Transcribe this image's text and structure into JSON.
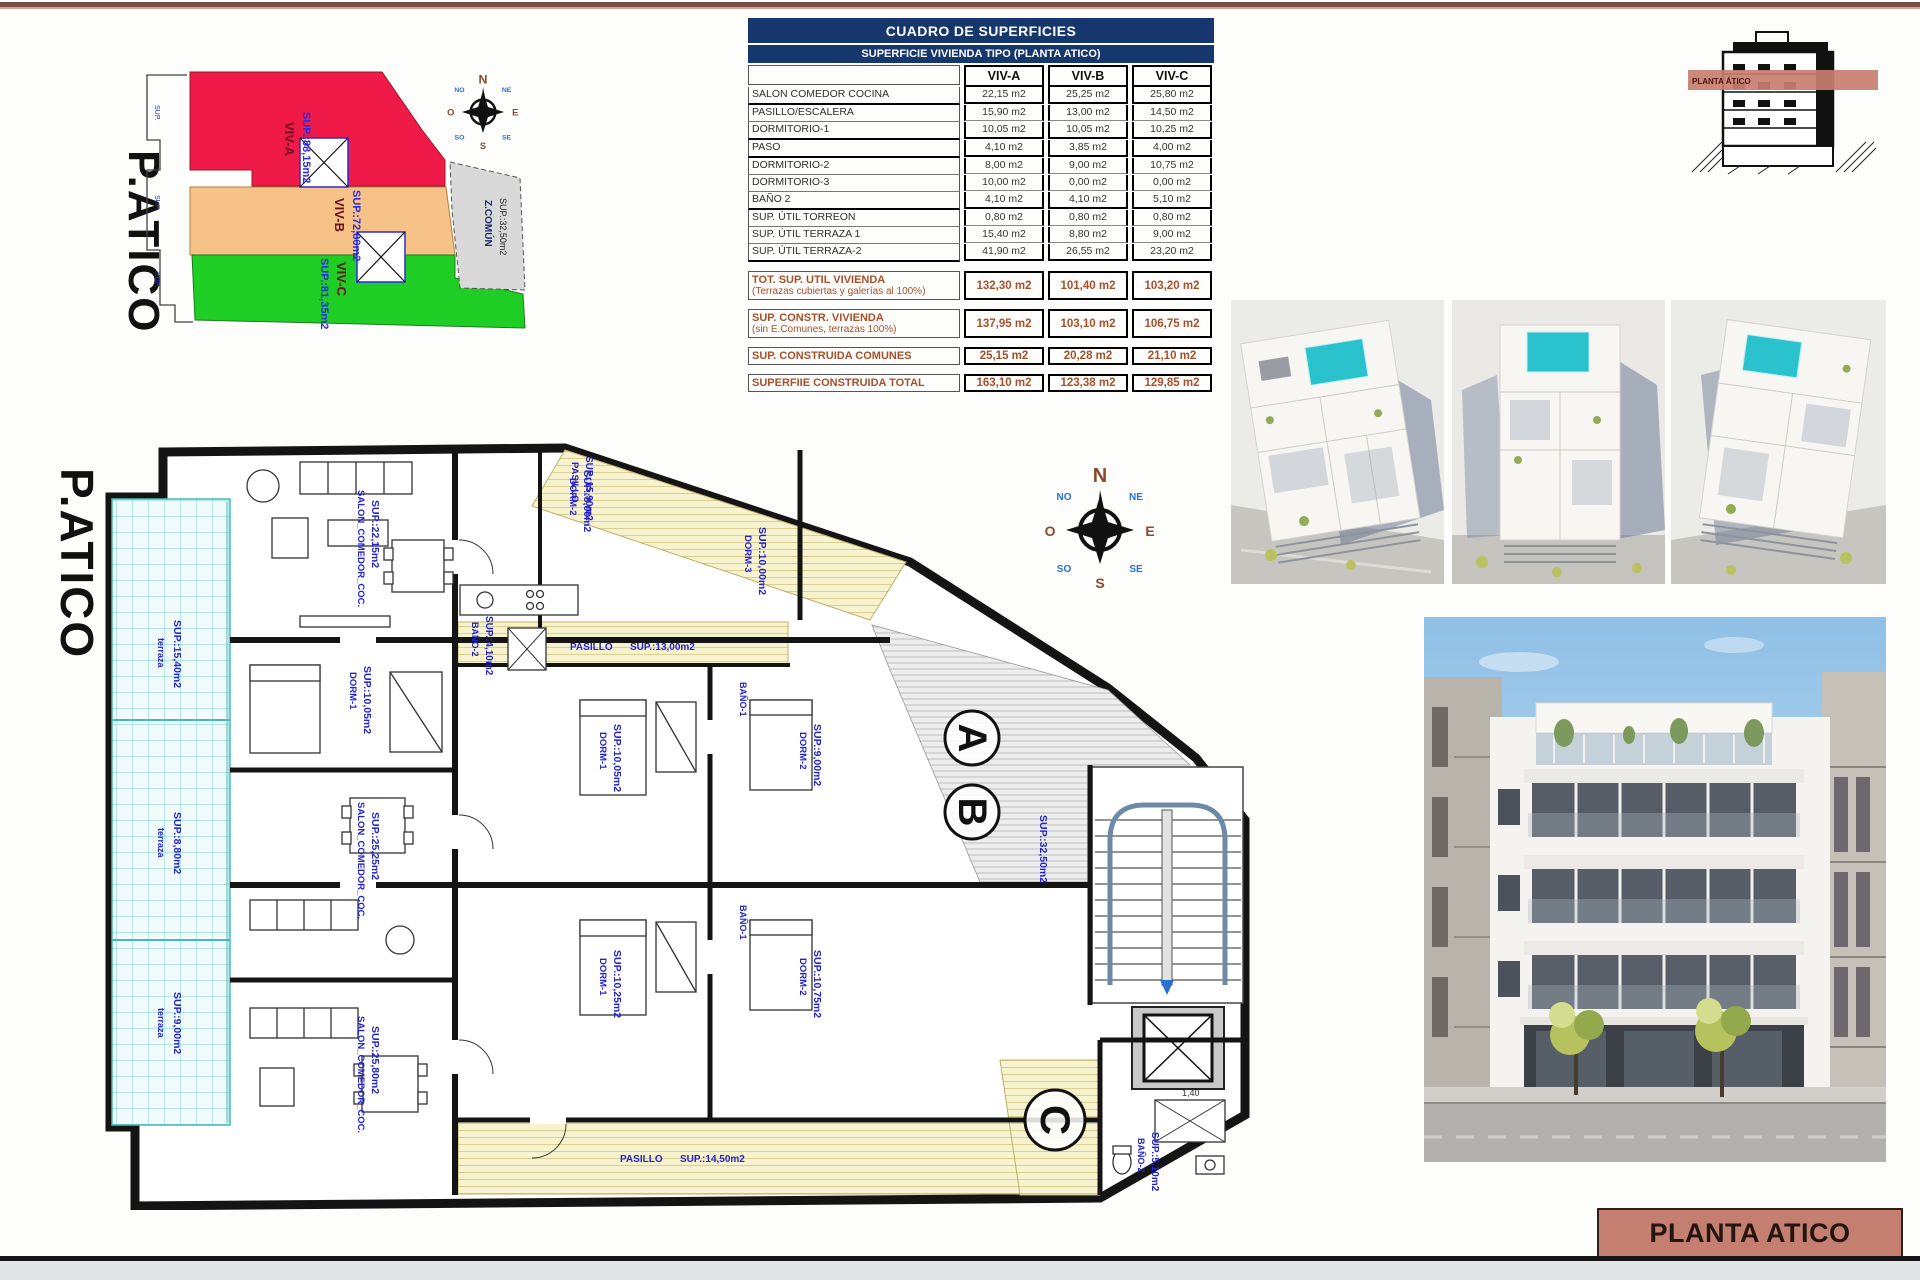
{
  "key_plan": {
    "title": "P.ATICO",
    "viv_a": "VIV-A",
    "viv_a_sup": "SUP.:88,15m2",
    "viv_b": "VIV-B",
    "viv_b_sup": "SUP.:72,80m2",
    "viv_c": "VIV-C",
    "viv_c_sup": "SUP.:81,35m2",
    "z_comun": "Z.COMÚN",
    "z_comun_sup": "SUP.:32,50m2",
    "edge_label_1": "SUP.",
    "edge_label_2": "SUP.",
    "edge_label_3": "SUP."
  },
  "compass": {
    "n": "N",
    "e": "E",
    "s": "S",
    "o": "O",
    "ne": "NE",
    "no": "NO",
    "se": "SE",
    "so": "SO"
  },
  "surface_table": {
    "title": "CUADRO DE SUPERFICIES",
    "subtitle": "SUPERFICIE VIVIENDA TIPO  (PLANTA ATICO)",
    "columns": {
      "a": "VIV-A",
      "b": "VIV-B",
      "c": "VIV-C"
    },
    "rows": [
      {
        "label": "SALON COMEDOR COCINA",
        "a": "22,15 m2",
        "b": "25,25 m2",
        "c": "25,80 m2"
      },
      {
        "label": "PASILLO/ESCALERA",
        "a": "15,90 m2",
        "b": "13,00 m2",
        "c": "14,50 m2"
      },
      {
        "label": "DORMITORIO-1",
        "a": "10,05 m2",
        "b": "10,05 m2",
        "c": "10,25 m2"
      },
      {
        "label": "PASO",
        "a": "4,10 m2",
        "b": "3,85 m2",
        "c": "4,00 m2"
      },
      {
        "label": "DORMITORIO-2",
        "a": "8,00 m2",
        "b": "9,00 m2",
        "c": "10,75 m2"
      },
      {
        "label": "DORMITORIO-3",
        "a": "10,00 m2",
        "b": "0,00 m2",
        "c": "0,00 m2"
      },
      {
        "label": "BAÑO 2",
        "a": "4,10 m2",
        "b": "4,10 m2",
        "c": "5,10 m2"
      },
      {
        "label": "SUP. ÚTIL TORREON",
        "a": "0,80 m2",
        "b": "0,80 m2",
        "c": "0,80 m2"
      },
      {
        "label": "SUP. ÚTIL TERRAZA 1",
        "a": "15,40 m2",
        "b": "8,80 m2",
        "c": "9,00 m2"
      },
      {
        "label": "SUP. ÚTIL TERRAZA-2",
        "a": "41,90 m2",
        "b": "26,55 m2",
        "c": "23,20 m2"
      }
    ],
    "totals": [
      {
        "label": "TOT. SUP. UTIL VIVIENDA",
        "sublabel": "(Terrazas cubiertas y galerías al 100%)",
        "a": "132,30 m2",
        "b": "101,40 m2",
        "c": "103,20 m2"
      },
      {
        "label": "SUP. CONSTR. VIVIENDA",
        "sublabel": "(sin E.Comunes, terrazas 100%)",
        "a": "137,95 m2",
        "b": "103,10 m2",
        "c": "106,75 m2"
      },
      {
        "label": "SUP. CONSTRUIDA COMUNES",
        "sublabel": "",
        "a": "25,15 m2",
        "b": "20,28 m2",
        "c": "21,10 m2"
      },
      {
        "label": "SUPERFIIE CONSTRUIDA TOTAL",
        "sublabel": "",
        "a": "163,10 m2",
        "b": "123,38 m2",
        "c": "129,85 m2"
      }
    ]
  },
  "section_diagram": {
    "band_label": "PLANTA ÁTICO"
  },
  "floor_plan": {
    "title": "P.ATICO",
    "unit_a": "A",
    "unit_b": "B",
    "unit_c": "C",
    "labels": {
      "terraza": "terraza",
      "terraza1_sup": "SUP.:15,40m2",
      "terraza2_sup": "SUP.:8,80m2",
      "terraza3_sup": "SUP.:9,00m2",
      "salon": "SALON_COMEDOR_COC.",
      "salon_a_sup": "SUP.:22,15m2",
      "salon_b_sup": "SUP.:25,25m2",
      "salon_c_sup": "SUP.:25,80m2",
      "dorm1": "DORM-1",
      "dorm1_a_sup": "SUP.:10,05m2",
      "dorm1_b_sup": "SUP.:10,05m2",
      "dorm1_c_sup": "SUP.:10,25m2",
      "dorm2": "DORM-2",
      "dorm2_a_sup": "SUP.:8,00m2",
      "dorm2_b_sup": "SUP.:9,00m2",
      "dorm2_c_sup": "SUP.:10,75m2",
      "dorm3": "DORM-3",
      "dorm3_a_sup": "SUP.:10,00m2",
      "bano1": "BAÑO-1",
      "bano2": "BAÑO-2",
      "bano2_a_sup": "SUP.:4,10m2",
      "bano2_c_sup": "SUP.:5,10m2",
      "pasillo": "PASILLO",
      "pasillo_a_sup": "SUP.:15,90m2",
      "pasillo_b_sup": "SUP.:13,00m2",
      "pasillo_c_sup": "SUP.:14,50m2",
      "comun_sup": "SUP.:32,50m2",
      "shower_dim": "1,40"
    }
  },
  "title_block": {
    "text": "PLANTA ATICO"
  }
}
